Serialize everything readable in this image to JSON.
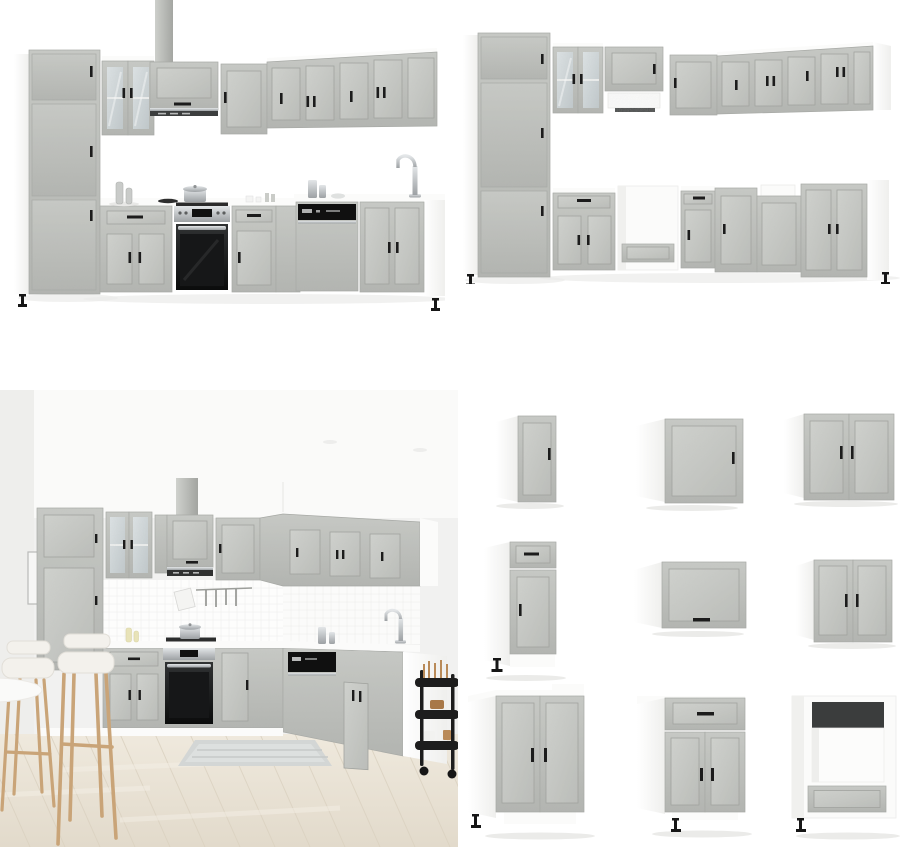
{
  "page": {
    "background": "#ffffff"
  },
  "colors": {
    "cabinet_grey": "#bcbeba",
    "cabinet_grey_light": "#cdcfcb",
    "cabinet_grey_dark": "#a2a4a0",
    "carcass_white": "#fbfbfa",
    "handle_black": "#1c1c1c",
    "appliance_black": "#141414",
    "steel": "#c9ccce",
    "glass": "#d0d7d9",
    "wall": "#f1f1f0",
    "ceiling": "#fafaf9",
    "floor_wood": "#e8e1d4",
    "rug": "#d3d6d5",
    "stool_wood": "#c9a478",
    "cushion": "#f3f1ec",
    "cart_black": "#1d1d1d",
    "shadow": "#ebebe9"
  },
  "panels": {
    "kitchen_set_full": {
      "label": "L-shaped concrete-grey kitchen cabinet set with oven, hood, sink and accessories"
    },
    "kitchen_set_bare": {
      "label": "L-shaped concrete-grey kitchen cabinet set without appliances"
    },
    "kitchen_scene": {
      "label": "Concrete-grey kitchen set staged in room with bar stools, kitchen cart and wood floor"
    },
    "module_grid": {
      "label": "Individual kitchen cabinet modules",
      "modules": [
        {
          "label": "Narrow single-door wall cabinet"
        },
        {
          "label": "Single-door wall cabinet"
        },
        {
          "label": "Wide double-door wall cabinet"
        },
        {
          "label": "Base cabinet with drawer and door"
        },
        {
          "label": "Horizontal flip-up wall cabinet"
        },
        {
          "label": "Double-door wall cabinet"
        },
        {
          "label": "Wide double-door sink base cabinet"
        },
        {
          "label": "Base cabinet with drawer and double doors"
        },
        {
          "label": "Oven housing base cabinet with drawer"
        }
      ]
    }
  }
}
